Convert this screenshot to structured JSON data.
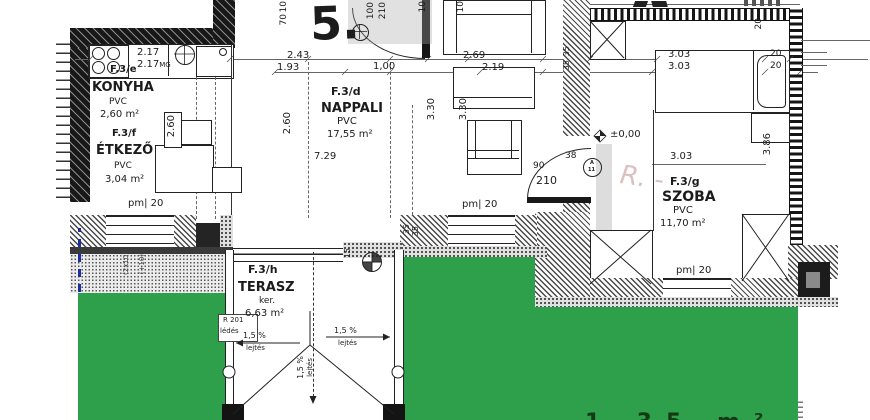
{
  "colors": {
    "green": "#2ea04c",
    "blue_marker": "#1e2e9e",
    "wall": "#181818"
  },
  "plan_number": "5.",
  "rooms": {
    "konyha": {
      "id": "F.3/e",
      "name": "KONYHA",
      "floor": "PVC",
      "area": "2,60 m²"
    },
    "etkezo": {
      "id": "F.3/f",
      "name": "ÉTKEZŐ",
      "floor": "PVC",
      "area": "3,04 m²"
    },
    "nappali": {
      "id": "F.3/d",
      "name": "NAPPALI",
      "floor": "PVC",
      "area": "17,55 m²"
    },
    "szoba": {
      "id": "F.3/g",
      "name": "SZOBA",
      "floor": "PVC",
      "area": "11,70 m²"
    },
    "terasz": {
      "id": "F.3/h",
      "name": "TERASZ",
      "floor": "ker.",
      "area": "6,63 m²"
    }
  },
  "dims": {
    "t217": "2.17",
    "t217b": "2.17",
    "mg": "MG",
    "t243": "2.43",
    "t193": "1.93",
    "t100": "1,00",
    "t269": "2.69",
    "t219": "2.19",
    "t303a": "3.03",
    "t303b": "3.03",
    "t303c": "3.03",
    "t20b": "20",
    "t20c": "20",
    "v70": "70",
    "v10a": "10",
    "v100": "100",
    "v210": "210",
    "v10b": "10",
    "v10c": "10",
    "v260a": "2.60",
    "v260b": "2.60",
    "v330a": "3.30",
    "v330b": "3.30",
    "v20a": "20",
    "v386": "3.86",
    "v35a": "35",
    "v35b": "35",
    "v35c": "35",
    "v35d": "35",
    "v15": "15",
    "i729": "7.29",
    "d90": "90",
    "d38": "38",
    "d210": "210",
    "pm20": "pm| 20",
    "level": "±0,00"
  },
  "slope": {
    "pct": "1,5 %",
    "word": "lejtés"
  },
  "notes": {
    "r201": "R 201",
    "r201b": "lédés",
    "n2x10": "(2x10)",
    "n10": "(+10)",
    "tag_letter": "A",
    "tag_number": "11",
    "bottom_cut": "1,35 m²"
  }
}
